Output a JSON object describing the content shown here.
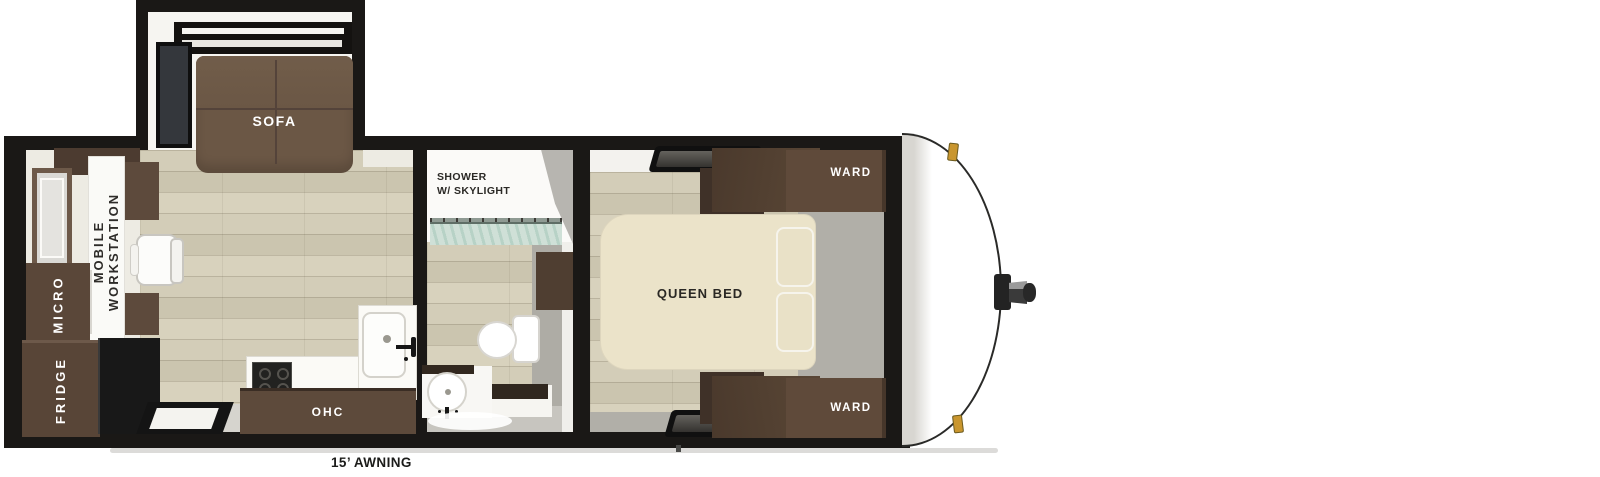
{
  "labels": {
    "sofa": "SOFA",
    "mobile_workstation": [
      "MOBILE",
      "WORKSTATION"
    ],
    "micro": "MICRO",
    "fridge": "FRIDGE",
    "ohc": "OHC",
    "shower": [
      "SHOWER",
      "W/ SKYLIGHT"
    ],
    "queen_bed": "QUEEN BED",
    "wards": [
      "WARD",
      "WARD"
    ],
    "awning": "15’ AWNING"
  },
  "colors": {
    "wall_black": "#1a1816",
    "wood_floor": "#d3cdb8",
    "cabinet_brown": "#5d4a3b",
    "cabinet_dark_brown": "#43342a",
    "sofa_brown": "#6b5745",
    "bed_cream": "#ebe3c9",
    "bedroom_gray": "#b1afa8",
    "shower_glass_green": "#cfe0d7",
    "marker_light_amber": "#c9962e",
    "label_dark": "#2a2824",
    "label_white": "#ffffff"
  }
}
